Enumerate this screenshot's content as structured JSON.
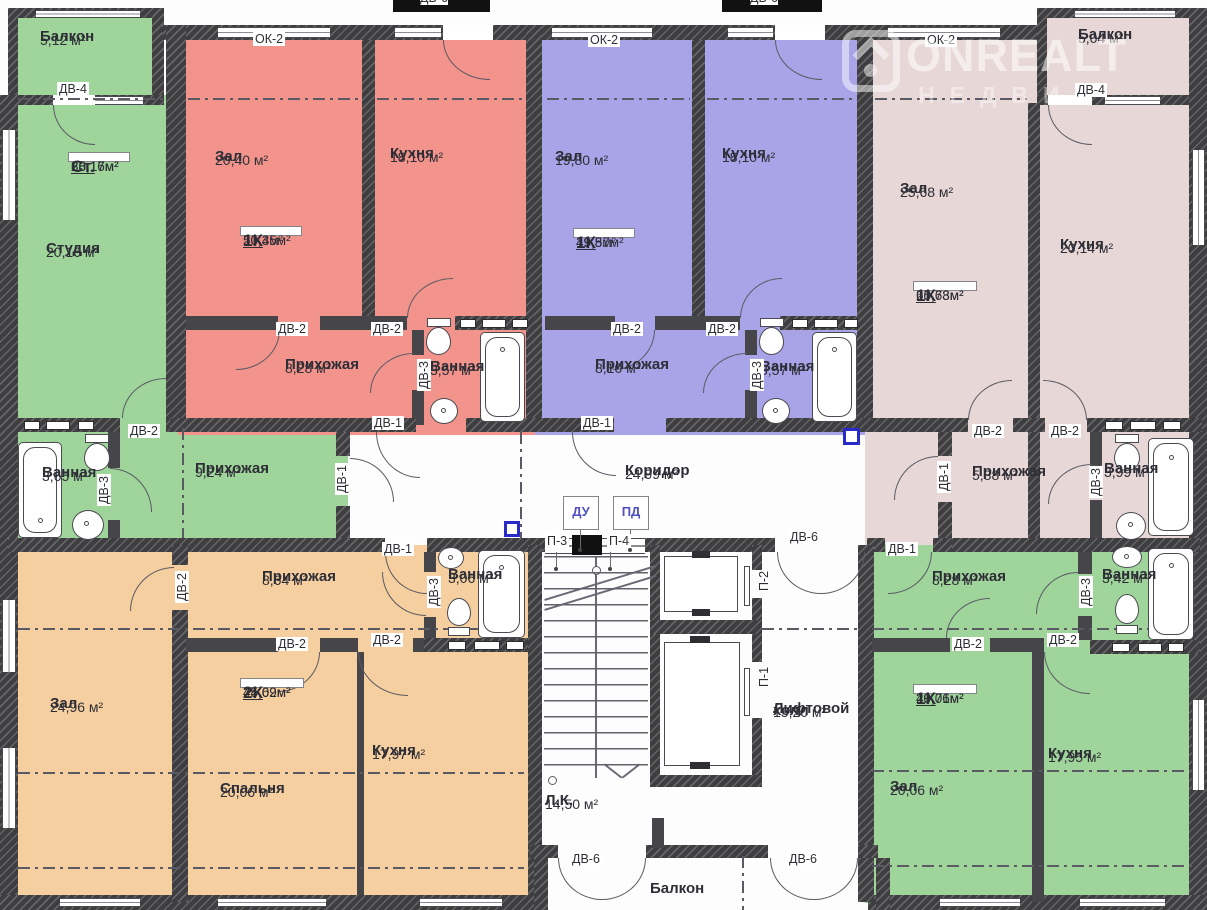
{
  "tags": {
    "dv1": "ДВ-1",
    "dv2": "ДВ-2",
    "dv3": "ДВ-3",
    "dv4": "ДВ-4",
    "dv6": "ДВ-6",
    "ok2": "ОК-2",
    "p1": "П-1",
    "p2": "П-2",
    "p3": "П-3",
    "p4": "П-4",
    "du": "ДУ",
    "pd": "ПД"
  },
  "watermark": {
    "brand": "ONREALT",
    "sub": "НЕДВИ"
  },
  "apartments": {
    "studio": {
      "balcony": {
        "n": "Балкон",
        "a": "5,12 м²"
      },
      "unit": {
        "t": "Ст.",
        "a1": "20,16м²",
        "a2": "38,17м²"
      },
      "main": {
        "n": "Студия",
        "a": "20,16 м²"
      },
      "hall": {
        "n": "Прихожая",
        "a": "9,24 м²"
      },
      "bath": {
        "n": "Ванная",
        "a": "3,65 м²"
      }
    },
    "red": {
      "zal": {
        "n": "Зал",
        "a": "20,40 м²"
      },
      "kitchen": {
        "n": "Кухня",
        "a": "18,10 м²"
      },
      "unit": {
        "t": "1К",
        "a1": "20,4м²",
        "a2": "50,35м²"
      },
      "hall": {
        "n": "Прихожая",
        "a": "8,28 м²"
      },
      "bath": {
        "n": "Ванная",
        "a": "3,57 м²"
      }
    },
    "blue": {
      "zal": {
        "n": "Зал",
        "a": "19,80 м²"
      },
      "kitchen": {
        "n": "Кухня",
        "a": "18,10 м²"
      },
      "unit": {
        "t": "1К",
        "a1": "19,8м²",
        "a2": "49,57м²"
      },
      "hall": {
        "n": "Прихожая",
        "a": "8,10 м²"
      },
      "bath": {
        "n": "Ванная",
        "a": "3,57 м²"
      }
    },
    "pink": {
      "balcony": {
        "n": "Балкон",
        "a": "5,04 м²"
      },
      "zal": {
        "n": "Зал",
        "a": "25,68 м²"
      },
      "kitchen": {
        "n": "Кухня",
        "a": "20,14 м²"
      },
      "unit": {
        "t": "1К",
        "a1": "25,68м²",
        "a2": "60,73м²"
      },
      "hall": {
        "n": "Прихожая",
        "a": "5,88 м²"
      },
      "bath": {
        "n": "Ванная",
        "a": "3,99 м²"
      }
    },
    "orange": {
      "zal": {
        "n": "Зал",
        "a": "24,96 м²"
      },
      "hall": {
        "n": "Прихожая",
        "a": "8,64 м²"
      },
      "bath": {
        "n": "Ванная",
        "a": "3,06 м²"
      },
      "unit": {
        "t": "2К",
        "a1": "45,02м²",
        "a2": "74,69м²"
      },
      "bedroom": {
        "n": "Спальня",
        "a": "20,06 м²"
      },
      "kitchen": {
        "n": "Кухня",
        "a": "17,97 м²"
      }
    },
    "green": {
      "hall": {
        "n": "Прихожая",
        "a": "8,28 м²"
      },
      "bath": {
        "n": "Ванная",
        "a": "3,42 м²"
      },
      "unit": {
        "t": "1К",
        "a1": "20,06м²",
        "a2": "49,71м²"
      },
      "zal": {
        "n": "Зал",
        "a": "20,06 м²"
      },
      "kitchen": {
        "n": "Кухня",
        "a": "17,95 м²"
      }
    }
  },
  "common": {
    "corridor": {
      "n": "Коридор",
      "a": "24,99 м²"
    },
    "stairs": {
      "n": "Л.К.",
      "a": "14,50 м²"
    },
    "lift": {
      "n1": "Лифтовой",
      "n2": "холл",
      "a": "15,20 м²"
    },
    "balcony": {
      "n": "Балкон"
    }
  },
  "colors": {
    "green": "#9fd49b",
    "red": "#f2948c",
    "blue": "#a9a4e8",
    "pink": "#e7d7d6",
    "orange": "#f6cfa0",
    "wall": "#3e3e41",
    "accent": "#2a2ac8"
  }
}
